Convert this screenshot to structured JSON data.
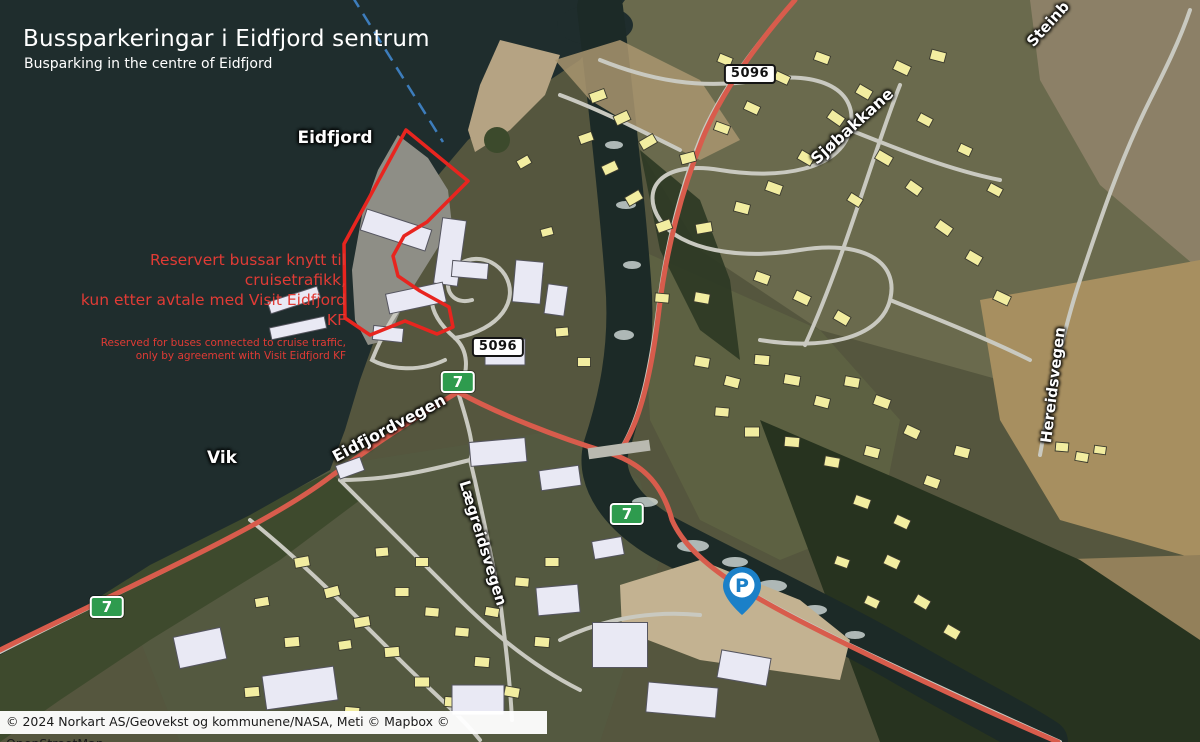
{
  "header": {
    "title": "Bussparkeringar i Eidfjord sentrum",
    "subtitle": "Busparking in the centre of Eidfjord"
  },
  "reserved_note": {
    "no_line1": "Reservert bussar knytt til cruisetrafikk,",
    "no_line2": "kun etter avtale med Visit Eidfjord KF",
    "en_line1": "Reserved for buses connected to cruise traffic,",
    "en_line2": "only by agreement with Visit Eidfjord KF"
  },
  "place_labels": {
    "fjord": "Eidfjord",
    "bay": "Vik"
  },
  "street_labels": {
    "sjobakkane": "Sjøbakkane",
    "steinberget": "Steinb",
    "hereidsvegen": "Hereidsvegen",
    "eidfjordvegen": "Eidfjordvegen",
    "laegreidsvegen": "Lægreidsvegen"
  },
  "road_signs": {
    "road_number": "5096",
    "route_number": "7"
  },
  "marker": {
    "parking_letter": "P"
  },
  "attribution": "© 2024 Norkart AS/Geovekst og kommunene/NASA, Meti © Mapbox © OpenStreetMap",
  "colors": {
    "route_shield_green": "#2e9b4e",
    "restricted_red": "#e8251f",
    "note_red": "#e03b35",
    "parking_blue": "#1b80c8",
    "boundary_dash_blue": "#3f82c4",
    "route_road_red": "#d85c4c",
    "water": "#1f2d2d"
  }
}
